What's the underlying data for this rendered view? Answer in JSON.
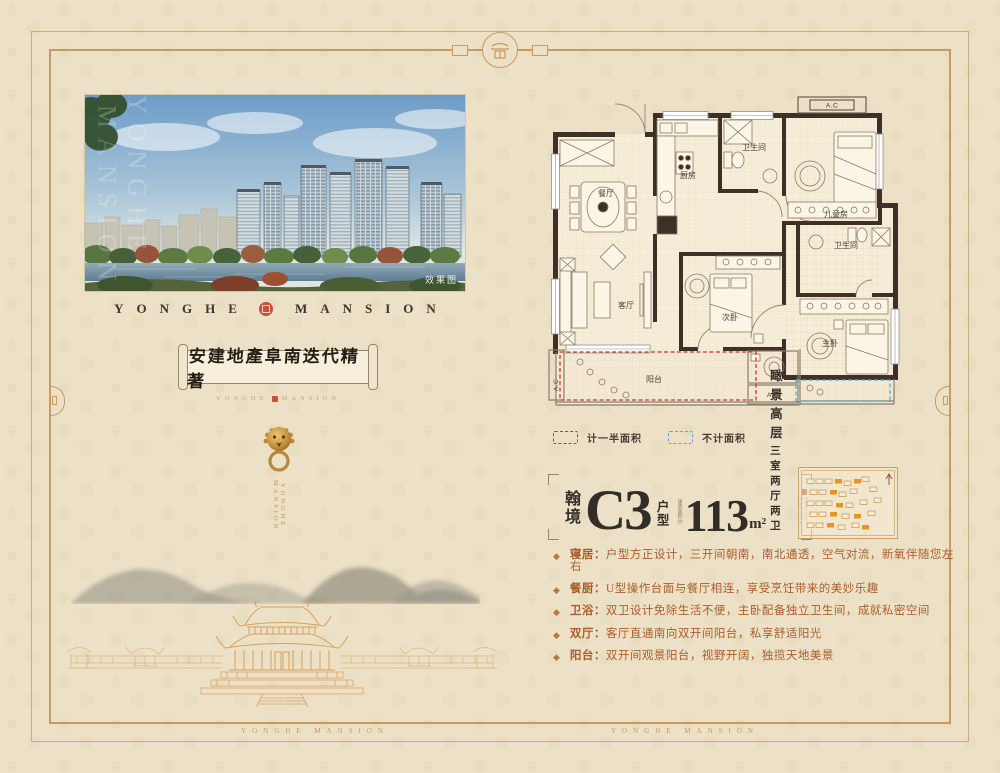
{
  "colors": {
    "frame": "#c79a5e",
    "seal_red": "#c8503c",
    "wall": "#3f3027",
    "legend_half": "#c23b2e",
    "legend_none": "#5aa7d7",
    "feature_text": "#a95f2c"
  },
  "hero": {
    "watermark": "效果图",
    "vertical_watermark_1": "YONGHE",
    "vertical_watermark_2": "MANSION"
  },
  "brand": {
    "left": "YONGHE",
    "right": "MANSION"
  },
  "scroll": {
    "calligraphy": "安建地產阜南迭代精著",
    "sub_left": "YONGHE",
    "sub_right": "MANSION"
  },
  "knocker": {
    "vertical_text": "YONGHE MANSION"
  },
  "floorplan": {
    "rooms": {
      "dining": "餐厅",
      "kitchen": "厨房",
      "bath1": "卫生间",
      "kids": "儿童房",
      "bath2": "卫生间",
      "living": "客厅",
      "bed2": "次卧",
      "master": "主卧",
      "balcony": "阳台"
    },
    "ac": "A.C",
    "legend": [
      {
        "label": "计一半面积",
        "color": "#c23b2e"
      },
      {
        "label": "不计面积",
        "color": "#5aa7d7"
      }
    ]
  },
  "unit": {
    "series": "翰境",
    "code": "C3",
    "type_label": "户型",
    "area_note": "建筑面积约",
    "area_value": "113",
    "area_unit": "m²",
    "tag1": "瞰景高层",
    "tag2": "三室两厅两卫",
    "brand_mark": "YONGHE MANSION"
  },
  "features": [
    {
      "label": "寝居：",
      "text": "户型方正设计，三开间朝南，南北通透，空气对流，新氧伴随您左右"
    },
    {
      "label": "餐厨：",
      "text": "U型操作台面与餐厅相连，享受烹饪带来的美妙乐趣"
    },
    {
      "label": "卫浴：",
      "text": "双卫设计免除生活不便，主卧配备独立卫生间，成就私密空间"
    },
    {
      "label": "双厅：",
      "text": "客厅直通南向双开间阳台，私享舒适阳光"
    },
    {
      "label": "阳台：",
      "text": "双开间观景阳台，视野开阔，独揽天地美景"
    }
  ],
  "footer": {
    "wm1": "YONGHE MANSION",
    "wm2": "YONGHE MANSION"
  }
}
